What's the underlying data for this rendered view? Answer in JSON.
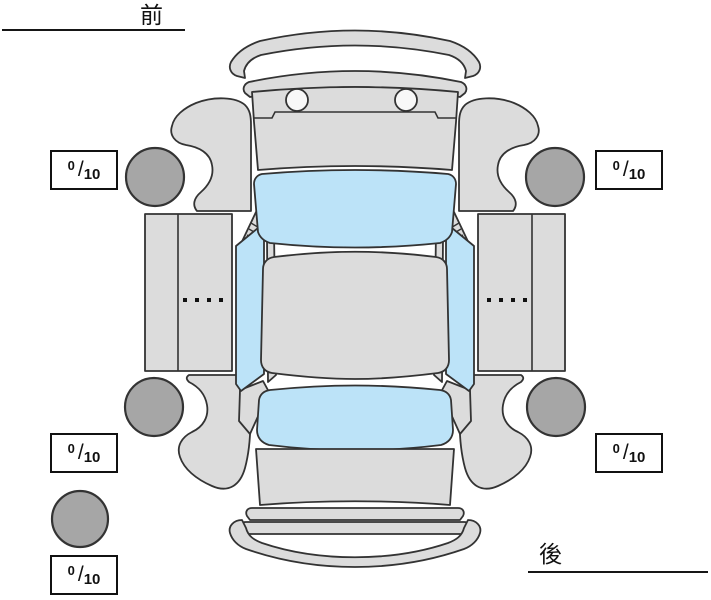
{
  "diagram": {
    "title": "vehicle-exterior-condition-diagram",
    "orientation_labels": {
      "front": "前",
      "rear": "後"
    },
    "scores": {
      "separator": "/",
      "front_left": {
        "value": "0",
        "max": "10"
      },
      "front_right": {
        "value": "0",
        "max": "10"
      },
      "rear_left": {
        "value": "0",
        "max": "10"
      },
      "rear_right": {
        "value": "0",
        "max": "10"
      },
      "spare": {
        "value": "0",
        "max": "10"
      }
    },
    "colors": {
      "body": "#dcdcdc",
      "window": "#bce3f8",
      "wheel": "#a6a6a6",
      "outline": "#333333",
      "background": "#ffffff",
      "headlight": "#f8f8f8"
    },
    "parts": [
      "front-bumper",
      "front-cowl-panel",
      "hood",
      "windshield",
      "roof",
      "rear-window",
      "trunk",
      "rear-panel",
      "rear-bumper",
      "left-front-fender",
      "left-rear-fender",
      "left-door-panel",
      "left-side-window",
      "right-front-fender",
      "right-rear-fender",
      "right-door-panel",
      "right-side-window",
      "front-left-wheel",
      "rear-left-wheel",
      "front-right-wheel",
      "rear-right-wheel",
      "spare-tire"
    ]
  }
}
